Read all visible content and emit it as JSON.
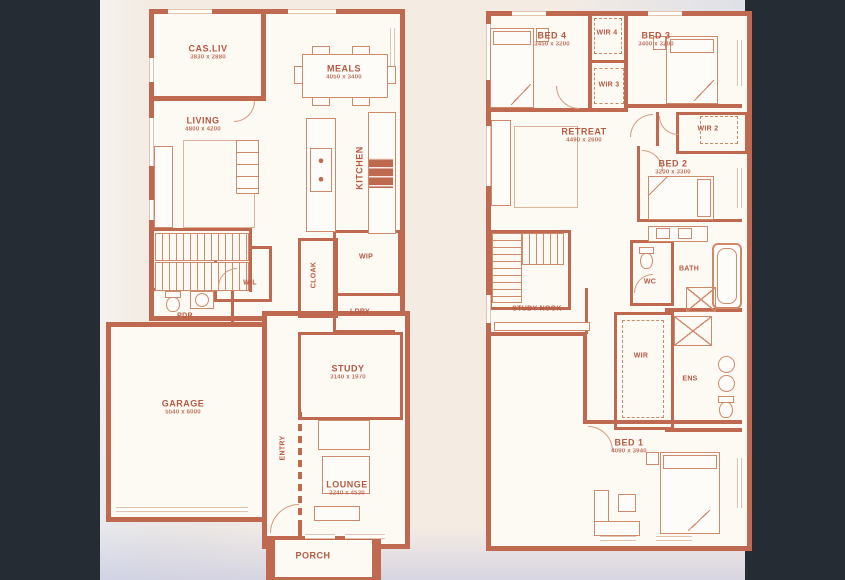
{
  "palette": {
    "wall": "#bf6950",
    "label_text": "#b65a42",
    "paper": "#f4ebe3",
    "room_fill": "#fdf9f3",
    "side_band": "#262c34"
  },
  "ground": {
    "name": "Ground Floor",
    "rooms": {
      "casliv": {
        "label": "CAS.LIV",
        "dims": "3830 x 2880"
      },
      "meals": {
        "label": "MEALS",
        "dims": "4050 x 3400"
      },
      "living": {
        "label": "LIVING",
        "dims": "4800 x 4200"
      },
      "kitchen": {
        "label": "KITCHEN"
      },
      "wil": {
        "label": "WIL"
      },
      "pdr": {
        "label": "PDR"
      },
      "cloak": {
        "label": "CLOAK"
      },
      "wip": {
        "label": "WIP"
      },
      "ldry": {
        "label": "LDRY"
      },
      "study": {
        "label": "STUDY",
        "dims": "3140 x 1970"
      },
      "garage": {
        "label": "GARAGE",
        "dims": "5540 x 6000"
      },
      "entry": {
        "label": "ENTRY"
      },
      "lounge": {
        "label": "LOUNGE",
        "dims": "3240 x 4530"
      },
      "porch": {
        "label": "PORCH"
      }
    }
  },
  "first": {
    "name": "First Floor",
    "rooms": {
      "bed4": {
        "label": "BED 4",
        "dims": "3450 x 3200"
      },
      "wir4": {
        "label": "WIR 4"
      },
      "bed3": {
        "label": "BED 3",
        "dims": "3400 x 3200"
      },
      "wir3": {
        "label": "WIR 3"
      },
      "retreat": {
        "label": "RETREAT",
        "dims": "4490 x 2600"
      },
      "wir2": {
        "label": "WIR 2"
      },
      "bed2": {
        "label": "BED 2",
        "dims": "3200 x 3300"
      },
      "studynook": {
        "label": "STUDY NOOK"
      },
      "wc": {
        "label": "WC"
      },
      "bath": {
        "label": "BATH"
      },
      "wir": {
        "label": "WIR"
      },
      "ens": {
        "label": "ENS"
      },
      "bed1": {
        "label": "BED 1",
        "dims": "4090 x 3940"
      }
    }
  }
}
